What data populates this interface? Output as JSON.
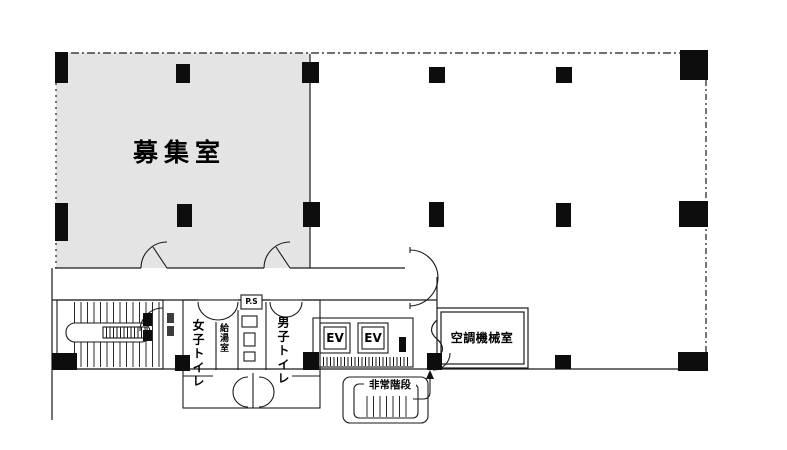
{
  "floor_plan": {
    "rooms": {
      "vacant_room": {
        "label": "募集室"
      },
      "womens_toilet": {
        "label": "女子トイレ"
      },
      "mens_toilet": {
        "label": "男子トイレ"
      },
      "kitchenette": {
        "label": "給湯室"
      },
      "pipe_space": {
        "label": "P.S"
      },
      "elevators": [
        {
          "label": "EV"
        },
        {
          "label": "EV"
        }
      ],
      "machine_room": {
        "label": "空調機械室"
      },
      "emergency_stairs": {
        "label": "非常階段"
      }
    },
    "colors": {
      "vacant_room_fill": "#e4e4e4",
      "line": "#1a1a1a",
      "column": "#0d0d0d",
      "background": "#ffffff"
    }
  }
}
